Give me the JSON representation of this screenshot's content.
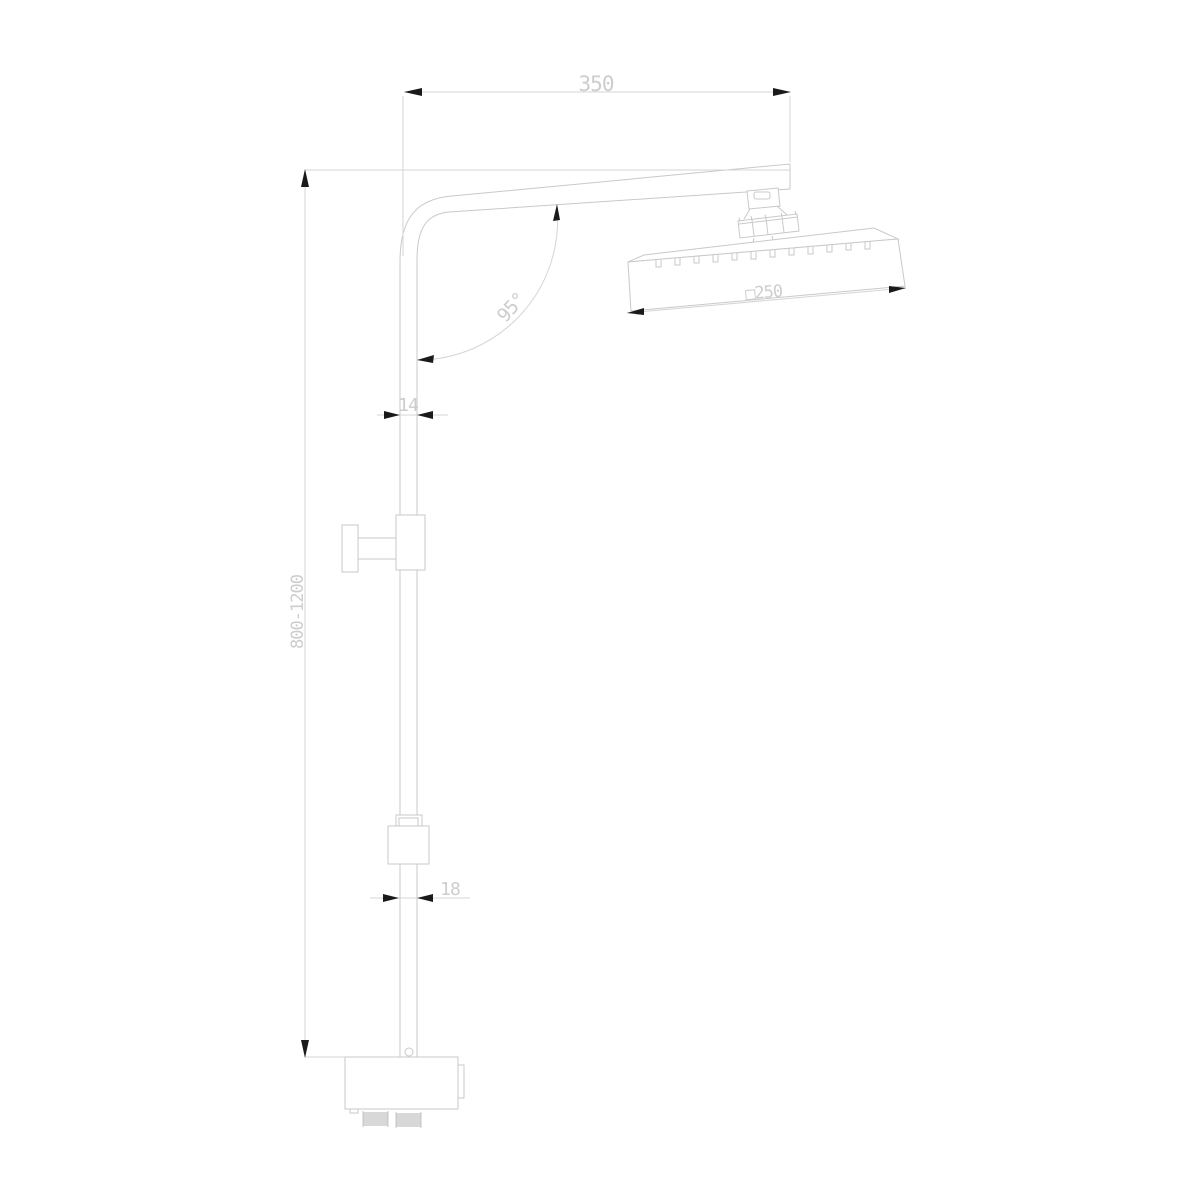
{
  "drawing": {
    "type": "technical-line-drawing",
    "subject": "wall-mounted shower column with square overhead shower",
    "dimensions": {
      "arm_width": "350",
      "column_height_range": "800-1200",
      "upper_pipe_diameter": "14",
      "lower_pipe_diameter": "18",
      "arm_angle": "95°",
      "head_size": "□250"
    },
    "colors": {
      "background": "#ffffff",
      "outline": "#c9c9c9",
      "dimension_line": "#d5d5d5",
      "dimension_text": "#cdcdcd",
      "arrow": "#1a1a1a",
      "thread_hatch": "#b2b2b2"
    }
  }
}
